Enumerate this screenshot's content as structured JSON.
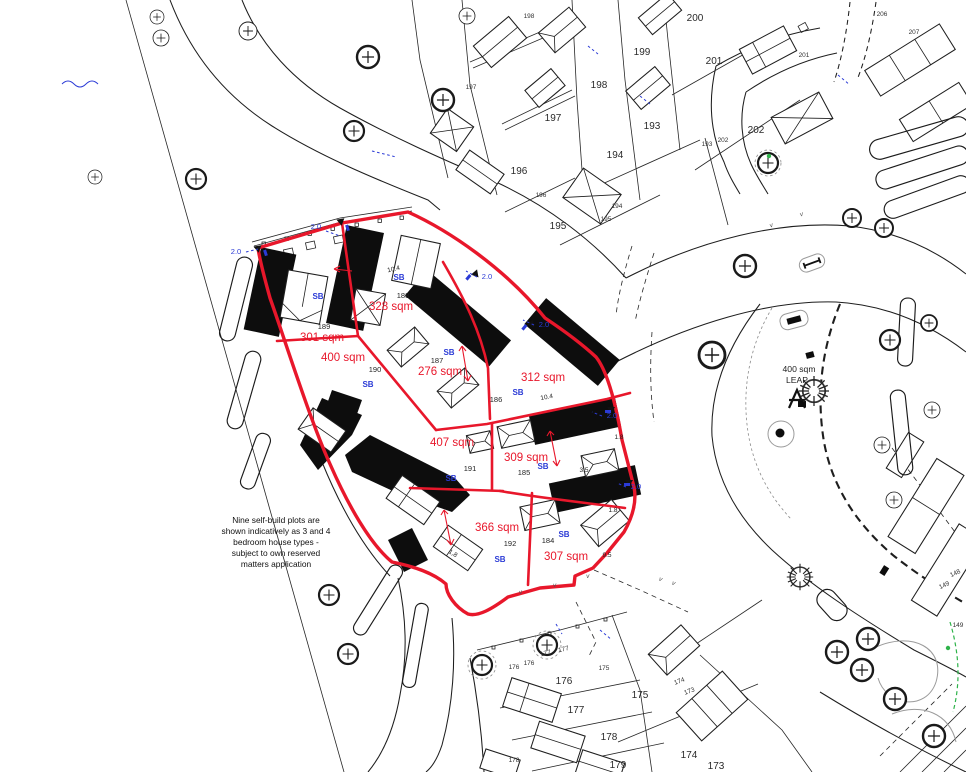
{
  "drawing": {
    "title": "Self-build plots site plan",
    "note_lines": [
      "Nine self-build plots are",
      "shown indicatively as 3 and 4",
      "bedroom house types -",
      "subject to own reserved",
      "matters application"
    ],
    "leap_area_label": "400 sqm",
    "leap_name_label": "LEAP"
  },
  "colors": {
    "plot_boundary_red": "#e8172b",
    "annotation_blue": "#2b3bd6",
    "linework_black": "#1e1e1e",
    "green_marker": "#2eb34a"
  },
  "site_plots": [
    {
      "number": "189",
      "area": "301 sqm",
      "tag": "SB"
    },
    {
      "number": "188",
      "area": "328 sqm",
      "tag": "SB"
    },
    {
      "number": "190",
      "area": "400 sqm",
      "tag": "SB"
    },
    {
      "number": "187",
      "area": "276 sqm",
      "tag": "SB"
    },
    {
      "number": "186",
      "area": "312 sqm",
      "tag": "SB"
    },
    {
      "number": "191",
      "area": "407 sqm",
      "tag": "SB"
    },
    {
      "number": "185",
      "area": "309 sqm",
      "tag": "SB"
    },
    {
      "number": "192",
      "area": "366 sqm",
      "tag": "SB"
    },
    {
      "number": "184",
      "area": "307 sqm",
      "tag": "SB"
    }
  ],
  "adjacent_plot_numbers_large": [
    "197",
    "198",
    "199",
    "200",
    "201",
    "202",
    "193",
    "194",
    "195",
    "196",
    "176",
    "177",
    "178",
    "175",
    "174",
    "179",
    "173"
  ],
  "adjacent_plot_numbers_small": [
    "198",
    "197",
    "196",
    "194",
    "195",
    "193",
    "201",
    "202",
    "206",
    "207",
    "176",
    "176",
    "177",
    "177",
    "175",
    "174",
    "173",
    "178",
    "148",
    "149",
    "149"
  ],
  "dimension_labels": {
    "blue": [
      "2.0",
      "2.0",
      "2.0",
      "2.0",
      "2.0",
      "2.0"
    ],
    "black": [
      "10.4",
      "10.4",
      "1.8",
      "1.8",
      "1,8",
      "3.5",
      "9.5"
    ]
  },
  "verge_mark": "v"
}
